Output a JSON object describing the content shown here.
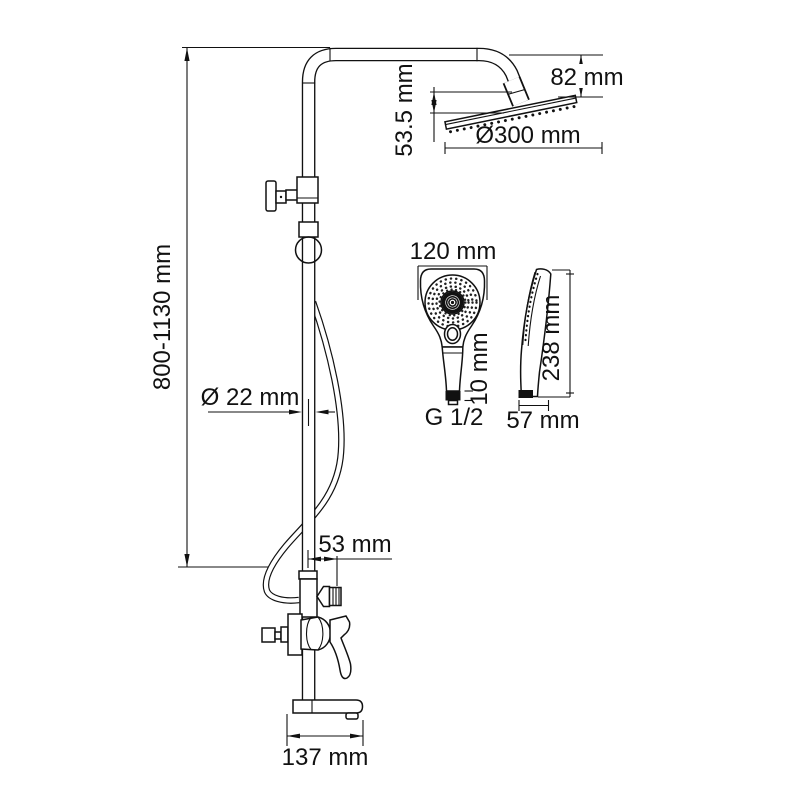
{
  "drawing": {
    "type": "shower-system-technical-drawing",
    "units": "mm",
    "colors": {
      "line": "#111111",
      "background": "#ffffff"
    },
    "dims": {
      "height_range": "800-1130 mm",
      "head_height_offset": "82 mm",
      "head_arm_drop": "53.5 mm",
      "head_diameter": "Ø300 mm",
      "pipe_diameter": "Ø 22 mm",
      "holder_offset": "53 mm",
      "spout_length": "137 mm",
      "hand_width": "120 mm",
      "hand_connector_length": "10 mm",
      "thread": "G 1/2",
      "hand_length": "238 mm",
      "hand_depth": "57 mm"
    }
  }
}
